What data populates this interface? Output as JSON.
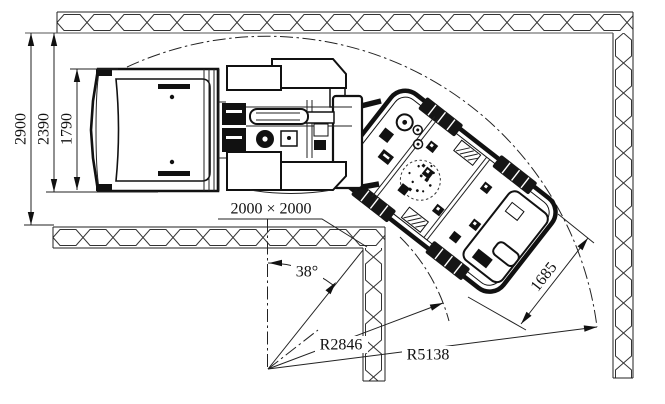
{
  "drawing": {
    "dimensions": {
      "tunnel_width": "2900",
      "clearance_envelope": "2390",
      "bucket_width": "1790",
      "opening_size": "2000 × 2000",
      "articulation_angle": "38°",
      "inner_turning_radius": "R2846",
      "outer_turning_radius": "R5138",
      "rear_frame_width": "1685"
    }
  }
}
